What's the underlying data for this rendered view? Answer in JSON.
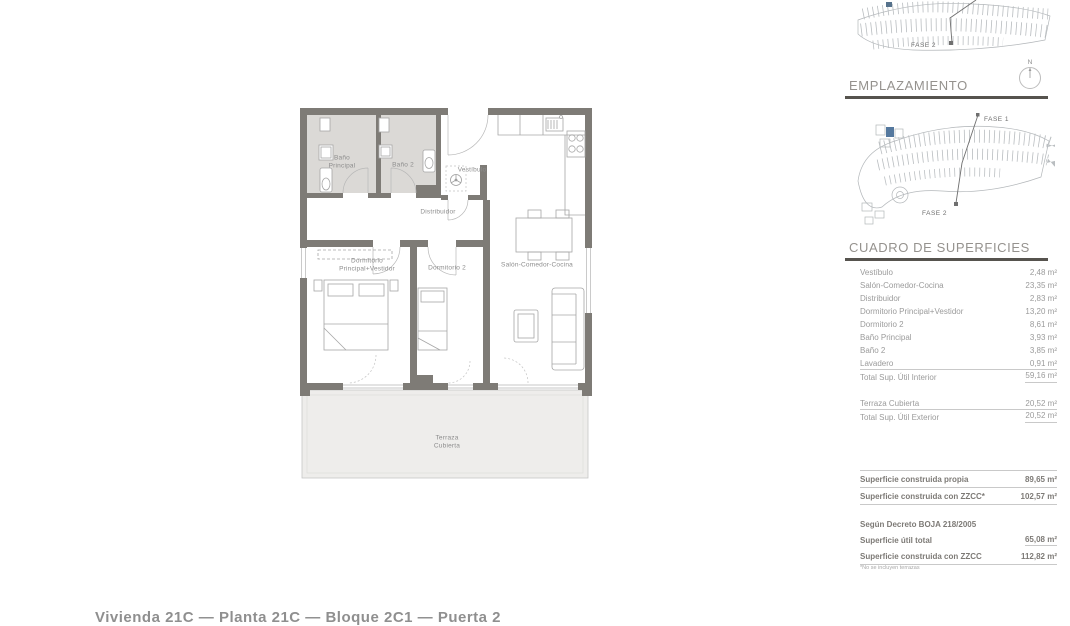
{
  "page": {
    "bottom_title": "Vivienda 21C — Planta 21C — Bloque 2C1 — Puerta 2"
  },
  "floor_plan": {
    "labels": {
      "bano_principal_line1": "Baño",
      "bano_principal_line2": "Principal",
      "bano_2": "Baño 2",
      "vestibulo": "Vestíbulo",
      "distribuidor": "Distribuidor",
      "dormitorio_principal_line1": "Dormitorio",
      "dormitorio_principal_line2": "Principal+Vestidor",
      "dormitorio_2": "Dormitorio 2",
      "salon": "Salón-Comedor-Cocina",
      "terraza_line1": "Terraza",
      "terraza_line2": "Cubierta"
    }
  },
  "sidebar": {
    "site_map_top": {
      "fase2_label": "FASE 2"
    },
    "emplazamiento": {
      "heading": "EMPLAZAMIENTO",
      "compass_letter": "N",
      "fase1_label": "FASE 1",
      "fase2_label": "FASE 2"
    },
    "cuadro": {
      "heading": "CUADRO DE SUPERFICIES",
      "rows": [
        {
          "label": "Vestíbulo",
          "value": "2,48 m²"
        },
        {
          "label": "Salón-Comedor-Cocina",
          "value": "23,35 m²"
        },
        {
          "label": "Distribuidor",
          "value": "2,83 m²"
        },
        {
          "label": "Dormitorio Principal+Vestidor",
          "value": "13,20 m²"
        },
        {
          "label": "Dormitorio 2",
          "value": "8,61 m²"
        },
        {
          "label": "Baño Principal",
          "value": "3,93 m²"
        },
        {
          "label": "Baño 2",
          "value": "3,85 m²"
        },
        {
          "label": "Lavadero",
          "value": "0,91 m²"
        },
        {
          "label": "Total Sup. Útil Interior",
          "value": "59,16 m²"
        },
        {
          "label": "Terraza Cubierta",
          "value": "20,52 m²"
        },
        {
          "label": "Total Sup. Útil Exterior",
          "value": "20,52 m²"
        }
      ],
      "summary": {
        "construida_propia_label": "Superficie construida propia",
        "construida_propia_value": "89,65 m²",
        "construida_zzcc_label": "Superficie construida con ZZCC*",
        "construida_zzcc_value": "102,57 m²",
        "decreto_heading": "Según Decreto BOJA 218/2005",
        "util_total_label": "Superficie útil total",
        "util_total_value": "65,08 m²",
        "construida_zzcc2_label": "Superficie construida con ZZCC",
        "construida_zzcc2_value": "112,82 m²",
        "footnote": "*No se incluyen terrazas"
      }
    }
  }
}
